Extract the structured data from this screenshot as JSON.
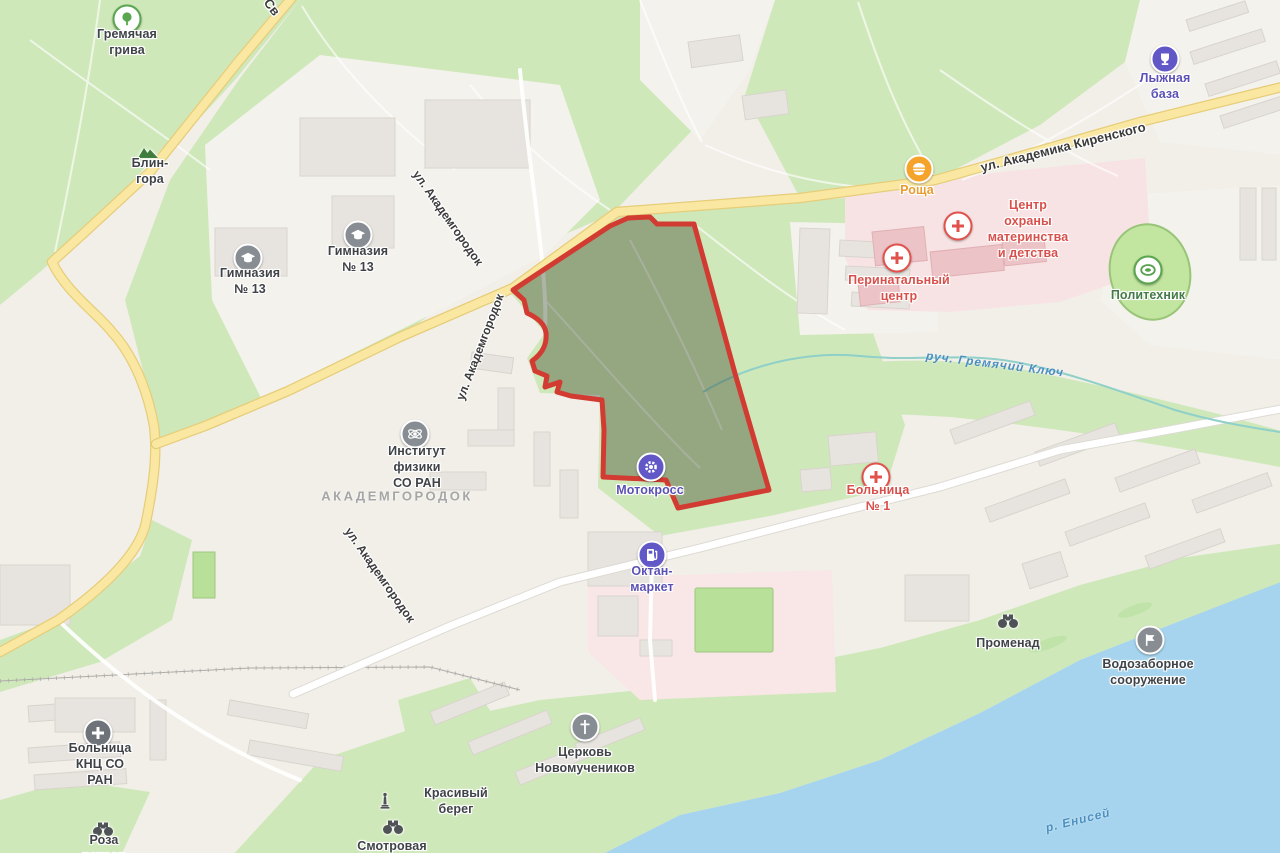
{
  "map": {
    "district_label": {
      "text": "АКАДЕМГОРОДОК",
      "x": 397,
      "y": 496
    },
    "colors": {
      "background": "#f2efe9",
      "park_green": "#cfe8ba",
      "water_blue": "#a6d4ee",
      "hospital_area_pink": "#f8e3e4",
      "road_yellow": "#f9e7a2",
      "selection_stroke_red": "#d23b32",
      "selection_fill_olive": "#3c4632",
      "poi_purple": "#6257c6",
      "poi_orange": "#f5a32b",
      "poi_medical_red": "#e2524d",
      "poi_green": "#5aa64f",
      "poi_gray": "#878d92"
    },
    "pois": [
      {
        "id": "gremyachaya-griva",
        "label": "Гремячая грива",
        "glyph": "tree",
        "circle": "tree",
        "label_color": "gray",
        "icon_x": 127,
        "icon_y": 19,
        "label_x": 127,
        "label_y": 42
      },
      {
        "id": "blin-gora",
        "label": "Блин-гора",
        "glyph": "mountain",
        "circle": "plain",
        "label_color": "gray",
        "icon_x": 148,
        "icon_y": 152,
        "label_x": 150,
        "label_y": 171
      },
      {
        "id": "gymnasium-13-west",
        "label": "Гимназия № 13",
        "glyph": "school",
        "circle": "gray",
        "label_color": "gray",
        "icon_x": 248,
        "icon_y": 258,
        "label_x": 250,
        "label_y": 281
      },
      {
        "id": "gymnasium-13-east",
        "label": "Гимназия № 13",
        "glyph": "school",
        "circle": "gray",
        "label_color": "gray",
        "icon_x": 358,
        "icon_y": 235,
        "label_x": 358,
        "label_y": 259
      },
      {
        "id": "lyzhnaya-baza",
        "label": "Лыжная база",
        "glyph": "trophy",
        "circle": "purple",
        "label_color": "purple",
        "icon_x": 1165,
        "icon_y": 59,
        "label_x": 1165,
        "label_y": 86
      },
      {
        "id": "roshcha",
        "label": "Роща",
        "glyph": "food",
        "circle": "orange",
        "label_color": "orange",
        "icon_x": 919,
        "icon_y": 169,
        "label_x": 917,
        "label_y": 190
      },
      {
        "id": "centr-ohrany-materinstva-i-detstva",
        "label": "Центр охраны\nматеринства\nи детства",
        "glyph": "crossmed",
        "circle": "med",
        "label_color": "red",
        "icon_x": 958,
        "icon_y": 226,
        "label_x": 1028,
        "label_y": 229
      },
      {
        "id": "perinatalny-centr",
        "label": "Перинатальный\nцентр",
        "glyph": "crossmed",
        "circle": "med",
        "label_color": "red",
        "icon_x": 897,
        "icon_y": 258,
        "label_x": 899,
        "label_y": 288
      },
      {
        "id": "politehnik",
        "label": "Политехник",
        "glyph": "stadium",
        "circle": "tree",
        "label_color": "green",
        "icon_x": 1148,
        "icon_y": 270,
        "label_x": 1148,
        "label_y": 295
      },
      {
        "id": "institut-fiziki-so-ran",
        "label": "Институт\nфизики СО РАН",
        "glyph": "atom",
        "circle": "gray",
        "label_color": "gray",
        "icon_x": 415,
        "icon_y": 434,
        "label_x": 417,
        "label_y": 467
      },
      {
        "id": "motokross",
        "label": "Мотокросс",
        "glyph": "gear",
        "circle": "purple",
        "label_color": "purple",
        "icon_x": 651,
        "icon_y": 467,
        "label_x": 650,
        "label_y": 490
      },
      {
        "id": "bolnitsa-1",
        "label": "Больница № 1",
        "glyph": "crossmed",
        "circle": "med",
        "label_color": "red",
        "icon_x": 876,
        "icon_y": 477,
        "label_x": 878,
        "label_y": 498
      },
      {
        "id": "oktan-market",
        "label": "Октан-маркет",
        "glyph": "fuel",
        "circle": "purple",
        "label_color": "purple",
        "icon_x": 652,
        "icon_y": 555,
        "label_x": 652,
        "label_y": 579
      },
      {
        "id": "tserkov-novomuchenikov",
        "label": "Церковь\nНовомучеников",
        "glyph": "church",
        "circle": "gray",
        "label_color": "gray",
        "icon_x": 585,
        "icon_y": 727,
        "label_x": 585,
        "label_y": 760
      },
      {
        "id": "promenad",
        "label": "Променад",
        "glyph": "binoculars",
        "circle": "plain",
        "label_color": "gray",
        "icon_x": 1008,
        "icon_y": 621,
        "label_x": 1008,
        "label_y": 643
      },
      {
        "id": "vodozabornoe-sooruzhenie",
        "label": "Водозаборное\nсооружение",
        "glyph": "flag",
        "circle": "gray",
        "label_color": "gray",
        "icon_x": 1150,
        "icon_y": 640,
        "label_x": 1148,
        "label_y": 672
      },
      {
        "id": "bolnitsa-knts-so-ran",
        "label": "Больница\nКНЦ СО РАН",
        "glyph": "hospital",
        "circle": "darkgray",
        "label_color": "gray",
        "icon_x": 98,
        "icon_y": 733,
        "label_x": 100,
        "label_y": 764
      },
      {
        "id": "roza-vetrov",
        "label": "Роза ветров",
        "glyph": "binoculars",
        "circle": "plain",
        "label_color": "gray",
        "icon_x": 103,
        "icon_y": 829,
        "label_x": 104,
        "label_y": 848
      },
      {
        "id": "krasivy-bereg",
        "label": "Красивый берег",
        "glyph": "monument",
        "circle": "plain",
        "label_color": "gray",
        "icon_x": 385,
        "icon_y": 801,
        "label_x": 456,
        "label_y": 801
      },
      {
        "id": "smotrovaya",
        "label": "Смотровая",
        "glyph": "binoculars",
        "circle": "plain",
        "label_color": "gray",
        "icon_x": 393,
        "icon_y": 827,
        "label_x": 392,
        "label_y": 846
      }
    ],
    "street_labels": [
      {
        "text": "ул. Академика Киренского",
        "x": 1063,
        "y": 147,
        "rotate": -14,
        "size": 13
      },
      {
        "text": "ул. Академгородок",
        "x": 448,
        "y": 218,
        "rotate": 55,
        "size": 12
      },
      {
        "text": "ул. Академгородок",
        "x": 480,
        "y": 347,
        "rotate": -69,
        "size": 12
      },
      {
        "text": "ул. Академгородок",
        "x": 380,
        "y": 575,
        "rotate": 55,
        "size": 12
      },
      {
        "text": "Св",
        "x": 272,
        "y": 7,
        "rotate": 52,
        "size": 13
      }
    ],
    "water_labels": [
      {
        "text": "руч. Гремячий Ключ",
        "x": 995,
        "y": 364,
        "rotate": 7
      },
      {
        "text": "р. Енисей",
        "x": 1078,
        "y": 820,
        "rotate": -14
      }
    ]
  }
}
